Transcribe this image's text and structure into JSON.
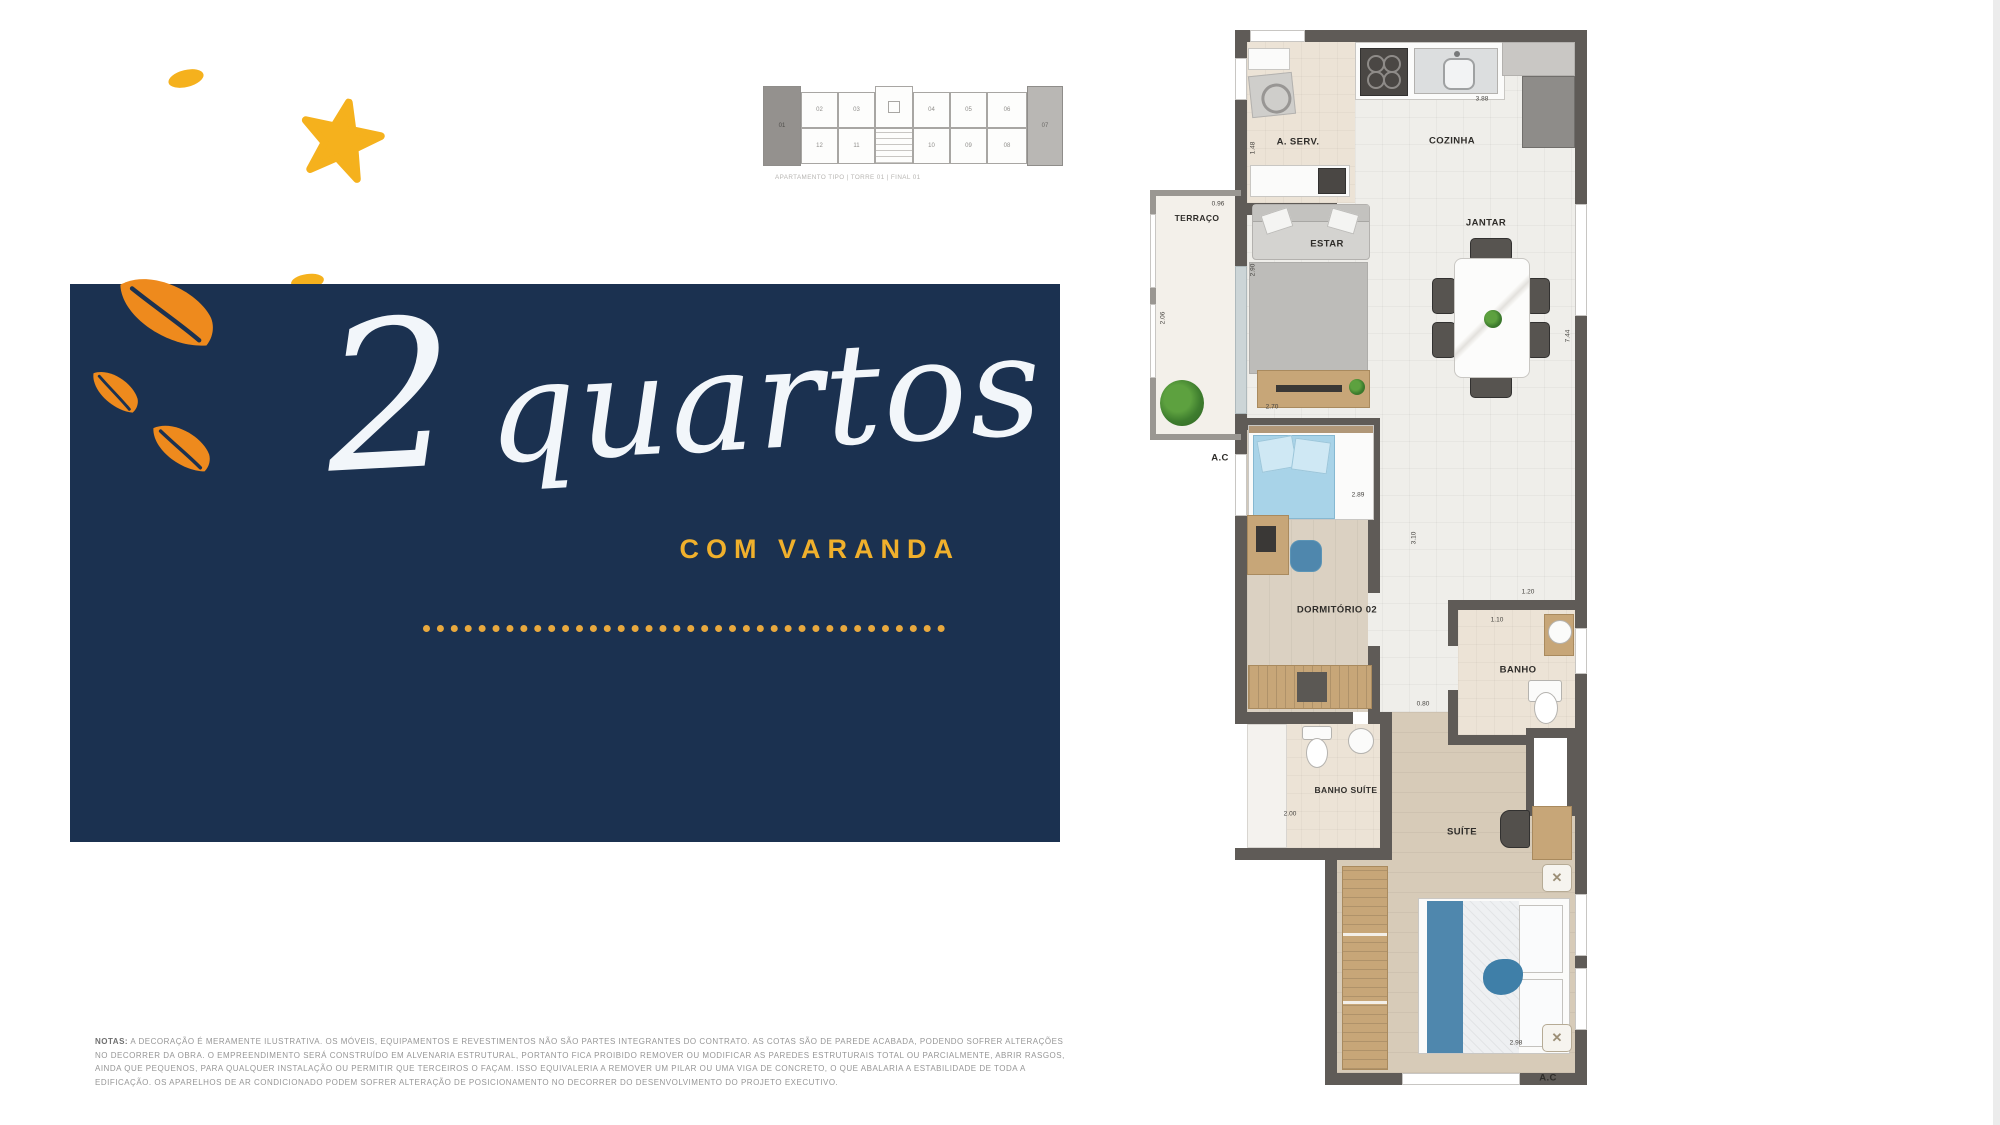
{
  "colors": {
    "navy_panel": "#1b3150",
    "accent_yellow": "#f2b02c",
    "accent_orange": "#ee8a1d",
    "plan_wall_gray": "#5f5b57"
  },
  "hero": {
    "number": "2",
    "word": "quartos",
    "subtitle": "COM VARANDA"
  },
  "key_plan": {
    "units_top": [
      "01",
      "02",
      "03",
      "04",
      "05",
      "06",
      "07"
    ],
    "units_bottom": [
      "12",
      "11",
      "10",
      "09",
      "08"
    ],
    "caption": "APARTAMENTO TIPO | TORRE 01 | FINAL 01"
  },
  "floorplan": {
    "rooms": {
      "servico": "A. SERV.",
      "cozinha": "COZINHA",
      "jantar": "JANTAR",
      "terraco": "TERRAÇO",
      "estar": "ESTAR",
      "dormitorio": "DORMITÓRIO 02",
      "banho": "BANHO",
      "banho_suite": "BANHO SUÍTE",
      "suite": "SUÍTE",
      "ac_left": "A.C",
      "ac_bottom": "A.C"
    },
    "dims": {
      "cozinha_top": "3.88",
      "servico_left": "1.48",
      "terraco_top": "0.96",
      "terraco_left": "2.06",
      "estar_left": "2.90",
      "estar_bottom": "2.70",
      "dormitorio_top": "2.89",
      "corridor_v": "3.10",
      "corridor_bottom": "0.80",
      "jantar_right": "7.44",
      "banho_top": "1.20",
      "banho_inner": "1.10",
      "banho_suite_bottom": "2.00",
      "suite_bottom": "2.98"
    }
  },
  "disclaimer": {
    "label": "NOTAS:",
    "line1": "A DECORAÇÃO É MERAMENTE ILUSTRATIVA. OS MÓVEIS, EQUIPAMENTOS E REVESTIMENTOS NÃO SÃO PARTES INTEGRANTES DO CONTRATO. AS COTAS SÃO DE PAREDE ACABADA, PODENDO SOFRER ALTERAÇÕES",
    "line2": "NO DECORRER DA OBRA. O EMPREENDIMENTO SERÁ CONSTRUÍDO EM ALVENARIA ESTRUTURAL, PORTANTO FICA PROIBIDO REMOVER OU MODIFICAR AS PAREDES ESTRUTURAIS TOTAL OU PARCIALMENTE, ABRIR RASGOS,",
    "line3": "AINDA QUE PEQUENOS, PARA QUALQUER INSTALAÇÃO OU PERMITIR QUE TERCEIROS O FAÇAM. ISSO EQUIVALERIA A REMOVER UM PILAR OU UMA VIGA DE CONCRETO, O QUE ABALARIA A ESTABILIDADE DE TODA A",
    "line4": "EDIFICAÇÃO. OS APARELHOS DE AR CONDICIONADO PODEM SOFRER ALTERAÇÃO DE POSICIONAMENTO NO DECORRER DO DESENVOLVIMENTO DO PROJETO EXECUTIVO."
  }
}
